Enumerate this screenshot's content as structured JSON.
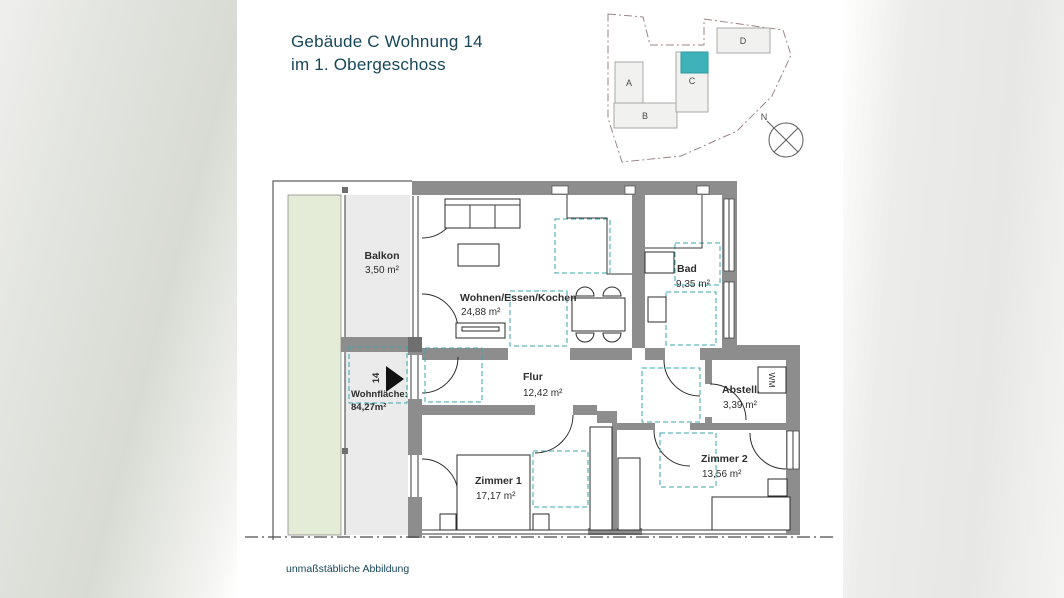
{
  "header": {
    "title_line1": "Gebäude C Wohnung 14",
    "title_line2": "im 1. Obergeschoss"
  },
  "site_plan": {
    "buildings": [
      {
        "label": "A"
      },
      {
        "label": "B"
      },
      {
        "label": "C",
        "highlighted": true
      },
      {
        "label": "D"
      }
    ],
    "highlight_building": "C",
    "compass_north_label": "N"
  },
  "floor_plan": {
    "rooms": [
      {
        "name": "Balkon",
        "area": "3,50 m²"
      },
      {
        "name": "Wohnen/Essen/Kochen",
        "area": "24,88 m²"
      },
      {
        "name": "Bad",
        "area": "9,35 m²"
      },
      {
        "name": "Flur",
        "area": "12,42 m²"
      },
      {
        "name": "Abstell.",
        "area": "3,39 m²"
      },
      {
        "name": "Zimmer 1",
        "area": "17,17 m²"
      },
      {
        "name": "Zimmer 2",
        "area": "13,56 m²"
      }
    ],
    "living_area": {
      "label": "Wohnfläche:",
      "value": "84,27m²"
    },
    "apartment_number": "14",
    "appliance_label": "WM"
  },
  "footer": {
    "note": "unmaßstäbliche Abbildung"
  },
  "colors": {
    "accent_teal": "#3db3b9",
    "dashed_teal": "#3aa7ae",
    "wall_grey": "#8d8d8d",
    "surface_grey": "#ebebeb",
    "garden_green": "#e4ecd7",
    "title_text": "#17475a",
    "boundary_line": "#9b8585"
  }
}
